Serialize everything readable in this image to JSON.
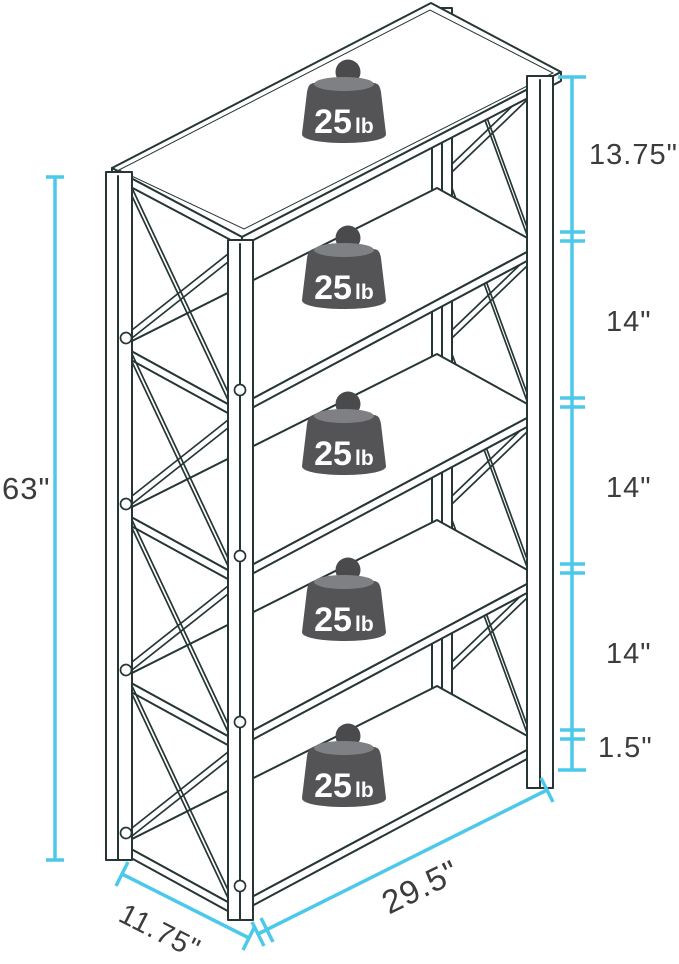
{
  "diagram_title": "5-tier bookshelf dimension diagram",
  "colors": {
    "accent": "#4bc8ea",
    "line_color": "#253634",
    "label_color": "#3c3c3c",
    "weight_body": "#545457",
    "weight_top": "#7e8083",
    "weight_ball": "#4a4a4c"
  },
  "weights": [
    {
      "value": "25",
      "unit": "lb"
    },
    {
      "value": "25",
      "unit": "lb"
    },
    {
      "value": "25",
      "unit": "lb"
    },
    {
      "value": "25",
      "unit": "lb"
    },
    {
      "value": "25",
      "unit": "lb"
    }
  ],
  "dimensions": {
    "total_height": "63\"",
    "right_segments": [
      "13.75\"",
      "14\"",
      "14\"",
      "14\"",
      "1.5\""
    ],
    "bottom_width": "29.5\"",
    "bottom_depth": "11.75\""
  }
}
